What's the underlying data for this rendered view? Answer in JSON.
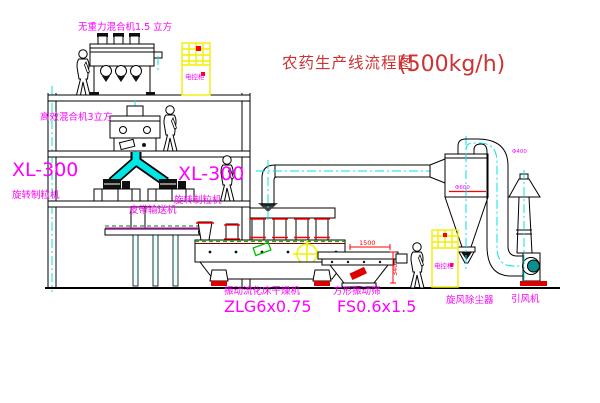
{
  "title": {
    "text": "农药生产线流程图",
    "capacity": "(500kg/h)"
  },
  "equipment": {
    "gravity_free_mixer": "无重力混合机1.5 立方",
    "high_efficiency_mixer": "高效混合机3立方",
    "granulator_model": "XL-300",
    "granulator_name": "旋转制粒机",
    "belt_conveyor": "皮带输送机",
    "dryer_name": "振动流化床干燥机",
    "dryer_model": "ZLG6x0.75",
    "sieve_name": "方形振动筛",
    "sieve_model": "FS0.6x1.5",
    "cyclone_name": "旋风除尘器",
    "cyclone_diameter": "Φ600",
    "fan_name": "引风机",
    "stack_diameter": "Φ400",
    "control_cabinet": "电控柜"
  },
  "dimensions": {
    "sieve_length": "1500",
    "sieve_height": "340"
  },
  "colors": {
    "label_magenta": "#ff00ff",
    "title_red": "#cc3333",
    "centerline_cyan": "#00e5e5",
    "cabinet_yellow": "#f0f000",
    "accent_red": "#ff0000",
    "accent_green": "#00bb00",
    "motor_teal": "#0a8f8f"
  }
}
